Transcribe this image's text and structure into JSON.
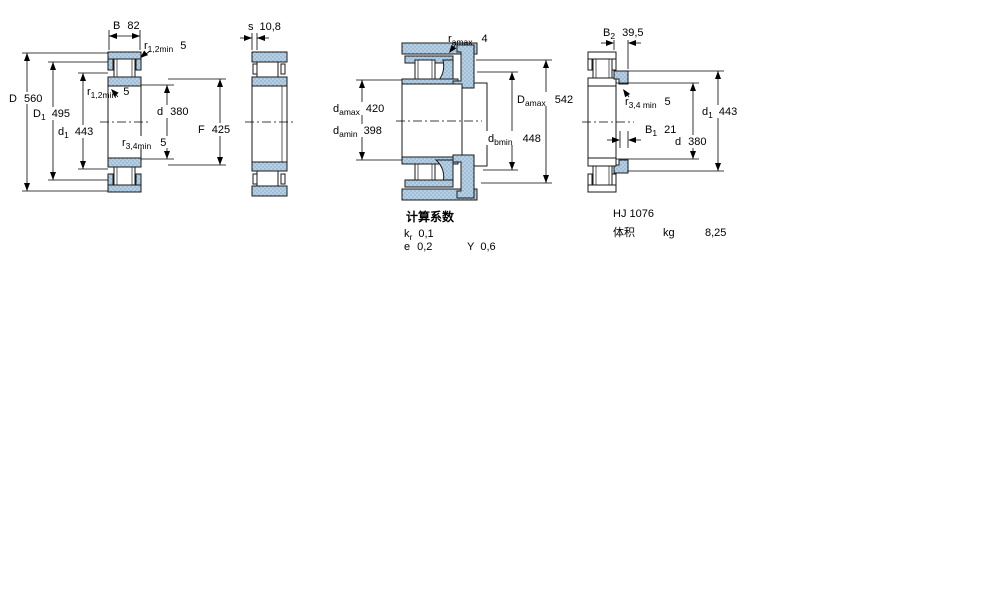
{
  "views": {
    "main": {
      "dims": {
        "B": {
          "sym": "B",
          "val": "82"
        },
        "r12a": {
          "sym": "r",
          "sub": "1,2min",
          "val": "5"
        },
        "D": {
          "sym": "D",
          "val": "560"
        },
        "D1": {
          "sym": "D",
          "sub": "1",
          "val": "495"
        },
        "d1": {
          "sym": "d",
          "sub": "1",
          "val": "443"
        },
        "r12b": {
          "sym": "r",
          "sub": "1,2min",
          "val": "5"
        },
        "d": {
          "sym": "d",
          "val": "380"
        },
        "F": {
          "sym": "F",
          "val": "425"
        },
        "r34": {
          "sym": "r",
          "sub": "3,4min",
          "val": "5"
        }
      }
    },
    "side": {
      "dims": {
        "s": {
          "sym": "s",
          "val": "10,8"
        }
      }
    },
    "mounting": {
      "dims": {
        "ra": {
          "sym": "r",
          "sub": "amax",
          "val": "4"
        },
        "damax": {
          "sym": "d",
          "sub": "amax",
          "val": "420"
        },
        "damin": {
          "sym": "d",
          "sub": "amin",
          "val": "398"
        },
        "Damax": {
          "sym": "D",
          "sub": "amax",
          "val": "542"
        },
        "dbmin": {
          "sym": "d",
          "sub": "bmin",
          "val": "448"
        }
      }
    },
    "ring": {
      "dims": {
        "B2": {
          "sym": "B",
          "sub": "2",
          "val": "39,5"
        },
        "r34": {
          "sym": "r",
          "sub": "3,4 min",
          "val": "5"
        },
        "B1": {
          "sym": "B",
          "sub": "1",
          "val": "21"
        },
        "d": {
          "sym": "d",
          "val": "380"
        },
        "d1": {
          "sym": "d",
          "sub": "1",
          "val": "443"
        }
      }
    }
  },
  "calculation_factors": {
    "title": "计算系数",
    "kr_sym": "k",
    "kr_sub": "r",
    "kr_val": "0,1",
    "e_sym": "e",
    "e_val": "0,2",
    "y_sym": "Y",
    "y_val": "0,6"
  },
  "angle_ring_info": {
    "designation": "HJ 1076",
    "mass_label": "体积",
    "mass_unit": "kg",
    "mass_value": "8,25"
  },
  "colors": {
    "section_fill": "#b6cfe2",
    "section_dot": "#7ea8cb",
    "outline": "#1a1a1a"
  }
}
